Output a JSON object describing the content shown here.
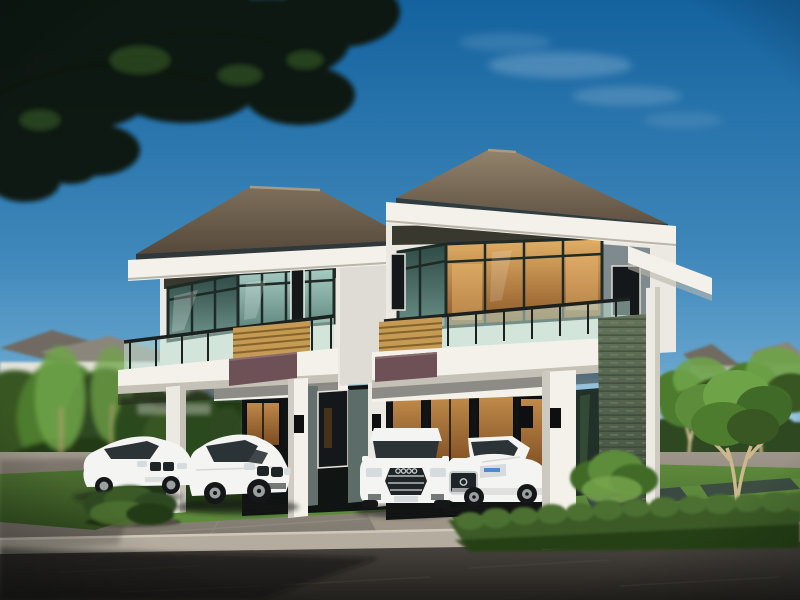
{
  "scene": {
    "type": "architectural-rendering",
    "description": "Twin modern two-storey detached houses with hip roofs, glass corner windows, balconies with glass railings and wood-slat screens, four white cars parked on the driveway, garden hedges and a dark paved road, with an overhanging tree branch against a blue sky",
    "objects": [
      "sky",
      "clouds",
      "overhanging-tree-branch",
      "background-neighbourhood-houses",
      "background-garden-trees",
      "left-house",
      "right-house",
      "balcony-glass-railing",
      "wood-slat-screen",
      "mauve-fascia-band",
      "stone-clad-pillar",
      "warm-lit-windows",
      "bmw-sedan-far",
      "bmw-sedan-near",
      "audi-suv",
      "mercedes-sedan",
      "lawn",
      "hedges",
      "driveway",
      "curb",
      "asphalt-road"
    ]
  },
  "colors": {
    "skyTop": "#14629e",
    "skyMid": "#3e87ba",
    "skyLow": "#7ab4d8",
    "skyHaze": "#c7dfec",
    "cloud": "#ffffff",
    "foliageDark": "#0b140b",
    "foliageMid": "#16240f",
    "foliageLight": "#2c4a1e",
    "branch": "#6e4f30",
    "branchLit": "#93704a",
    "bgRoof": "#8b867c",
    "bgRoofDark": "#6f6b62",
    "bgWall": "#e4e2da",
    "bgWallShade": "#c9c6bc",
    "bgWindow": "#4a4f4a",
    "treeGreen": "#4e7c2e",
    "treeGreenLight": "#6fa348",
    "treeGreenDark": "#395723",
    "trunkLight": "#cbb98d",
    "trunk": "#b09a6c",
    "hedgeDark": "#2f4a22",
    "hedge": "#3a5a26",
    "hedgeLump": "#4c7030",
    "hedgeShadow": "#243a16",
    "lawn": "#5e8a3c",
    "lawnDark": "#3c5c24",
    "lawnLight": "#6b9a46",
    "paver": "#3a4a42",
    "roofLitL": "#7d6f5b",
    "roofDarkL": "#57493a",
    "roofLitR": "#93836c",
    "roofDarkR": "#5f5142",
    "roofRidge": "#ab9a80",
    "eaveShadow": "#2f2a22",
    "fascia": "#f3f1ea",
    "fasciaShade": "#b9b5aa",
    "wall": "#ebe9e2",
    "wallShade": "#d9d6ce",
    "wallDark": "#c6c2b8",
    "soffit": "#39382f",
    "frame": "#1e2a26",
    "frameBlack": "#0d0f10",
    "glassCoolTop": "#a8ccc4",
    "glassCoolBot": "#5d857c",
    "glassCoolDarkTop": "#2e4a44",
    "glassCoolDarkBot": "#6e958c",
    "glassWarmTop": "#e2b066",
    "glassWarmBot": "#8a5526",
    "glassWarmBright": "#f4c27a",
    "windowDark": "#14181a",
    "warmLight": "#c08a4a",
    "warmDark": "#7a4a20",
    "railGlass": "#bfe0d6",
    "railPost": "#1c211f",
    "wood": "#c59a52",
    "woodDark": "#7a5a28",
    "mauve": "#6d5156",
    "mauveLit": "#8a6b6e",
    "grayAccent": "#7e8a8d",
    "grayAccentDark": "#6a7678",
    "tealWall": "#5c6c68",
    "grayWallSmall": "#64706e",
    "recess": "#101413",
    "stoneLit": "#64735a",
    "stoneDark": "#39463a",
    "stoneLine": "#2e3a2e",
    "stoneDash": "#7d8c70",
    "shrub": "#5d8c3a",
    "shrubDark": "#3f6a28",
    "shrubLight": "#79a84c",
    "drive": "#9e968a",
    "driveDark": "#7b746a",
    "driveLight": "#a89f90",
    "curb": "#b3ac9f",
    "curbLip": "#cfc8ba",
    "curbShade": "#8e877c",
    "road": "#4a4540",
    "roadDark": "#22201c",
    "roadStreak": "#6a645c",
    "shadow": "#0e0d0b",
    "carBody": "#f4f4f2",
    "carShade": "#d7d9d7",
    "carDark": "#141617",
    "carWindow": "#2c3336",
    "carGrille": "#1f2426",
    "carLight": "#d6dcde",
    "carBlue": "#4a8cd0",
    "rim": "#9aa0a0",
    "chrome": "#c6cccc"
  }
}
